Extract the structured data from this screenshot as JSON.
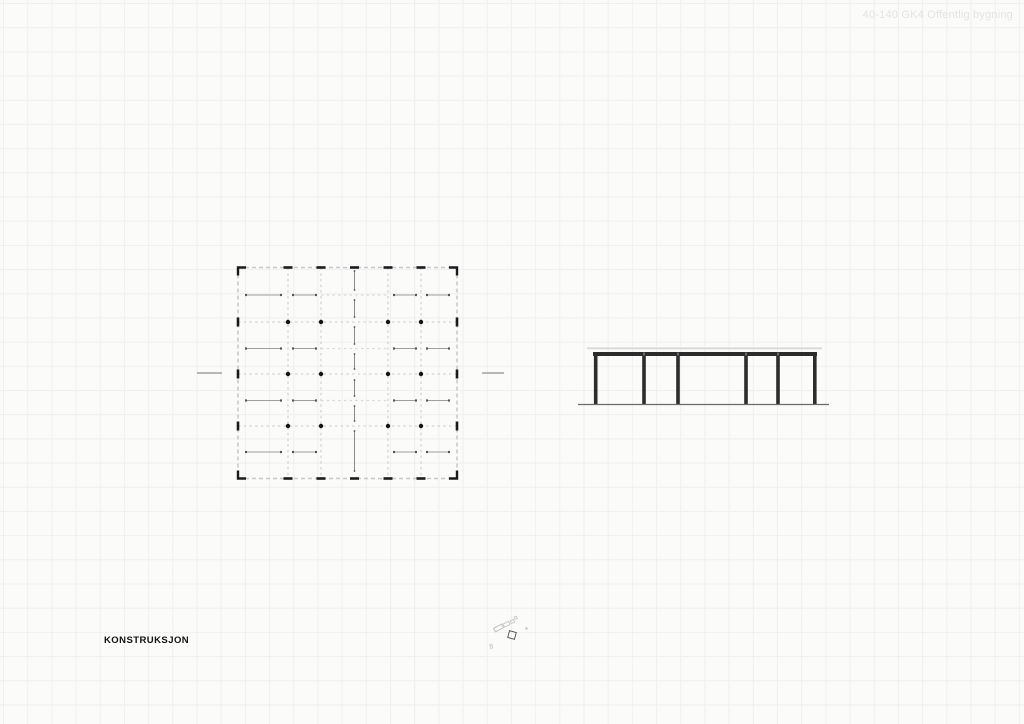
{
  "header": {
    "label": "40-140 GK4 Offentlig bygning"
  },
  "title": {
    "label": "KONSTRUKSJON"
  },
  "colors": {
    "background": "#fbfbfa",
    "grid_line": "#f0eff0",
    "plan_border_dash": "#c7c7c7",
    "plan_grid_dash": "#d3d3d3",
    "plan_mid_dash": "#d9d9d9",
    "mark_black": "#1b1b1b",
    "dot_black": "#141414",
    "arrow_line": "#9e9e9e",
    "arrow_cap": "#555555",
    "center_line": "#8a8a8a",
    "cut_mark": "#8e8e8e",
    "steel_dark": "#2c2c2c",
    "beam_seam": "#a8a8a8",
    "slab_light": "#d9d9d9",
    "ground_gray": "#6b6b6b",
    "header_text": "#e3e3e3",
    "title_text": "#121212",
    "marker_gray": "#bdbdbd",
    "marker_dark": "#4a4a4a"
  },
  "plan": {
    "frame": {
      "left": 238,
      "top": 267.5,
      "right": 457,
      "bottom": 478.5
    },
    "vlines": [
      288,
      321,
      388,
      421
    ],
    "hlines": [
      322,
      374,
      426
    ],
    "mid_hlines": {
      "ys": [
        295,
        348.5,
        400.5
      ],
      "x1": 321,
      "x2": 388
    },
    "top_ticks": [
      288,
      321,
      354.5,
      388,
      421
    ],
    "side_ticks": [
      322,
      374,
      426
    ],
    "dots": {
      "cols": [
        288,
        321,
        388,
        421
      ],
      "rows": [
        322,
        374,
        426
      ],
      "r": 2.2
    },
    "span_arrows": {
      "rows": [
        295,
        348.5,
        400.5,
        452
      ],
      "bays": [
        [
          246,
          281
        ],
        [
          293,
          316
        ],
        [
          394,
          416
        ],
        [
          427,
          449
        ]
      ]
    },
    "center_line": {
      "x": 354.5,
      "segments": [
        [
          271,
          290
        ],
        [
          300,
          317
        ],
        [
          327,
          344
        ],
        [
          354,
          369
        ],
        [
          380,
          396
        ],
        [
          406,
          421
        ],
        [
          431,
          471
        ]
      ]
    },
    "cut_marks": [
      {
        "x1": 197,
        "x2": 222,
        "y": 373
      },
      {
        "x1": 482,
        "x2": 504,
        "y": 373
      }
    ]
  },
  "elevation": {
    "slab": {
      "x1": 587,
      "x2": 822,
      "y": 348.3
    },
    "beam": {
      "x1": 593,
      "x2": 817,
      "y1": 352,
      "y2": 356
    },
    "columns": {
      "xs": [
        595.7,
        644,
        678,
        746,
        778,
        814.8
      ],
      "y1": 352.5,
      "y2": 404.5,
      "w": 3.6
    },
    "seams": [
      644,
      678,
      746,
      778
    ],
    "ground": {
      "x1": 578,
      "x2": 829,
      "y": 404.5
    }
  },
  "marker": {
    "glyphs": [
      {
        "type": "rect",
        "x": 494,
        "y": 626,
        "w": 9,
        "h": 4,
        "rot": -28,
        "color": "#b9b9b9"
      },
      {
        "type": "rect",
        "x": 503.5,
        "y": 622.5,
        "w": 6,
        "h": 3.5,
        "rot": -28,
        "color": "#c2c2c2"
      },
      {
        "type": "rect",
        "x": 510.5,
        "y": 620,
        "w": 3.5,
        "h": 3,
        "rot": -28,
        "color": "#c6c6c6"
      },
      {
        "type": "rect",
        "x": 514.5,
        "y": 616.5,
        "w": 2.5,
        "h": 2.5,
        "rot": -20,
        "color": "#c6c6c6"
      },
      {
        "type": "rect",
        "x": 508.5,
        "y": 631.5,
        "w": 7,
        "h": 7,
        "rot": 15,
        "color": "#4a4a4a"
      },
      {
        "type": "text",
        "x": 490,
        "y": 649,
        "text": "8",
        "rot": -15,
        "color": "#b5b5b5",
        "size": 7
      },
      {
        "type": "dot",
        "x": 526.5,
        "y": 628.5,
        "r": 1.2,
        "color": "#c0c0c0"
      }
    ]
  }
}
